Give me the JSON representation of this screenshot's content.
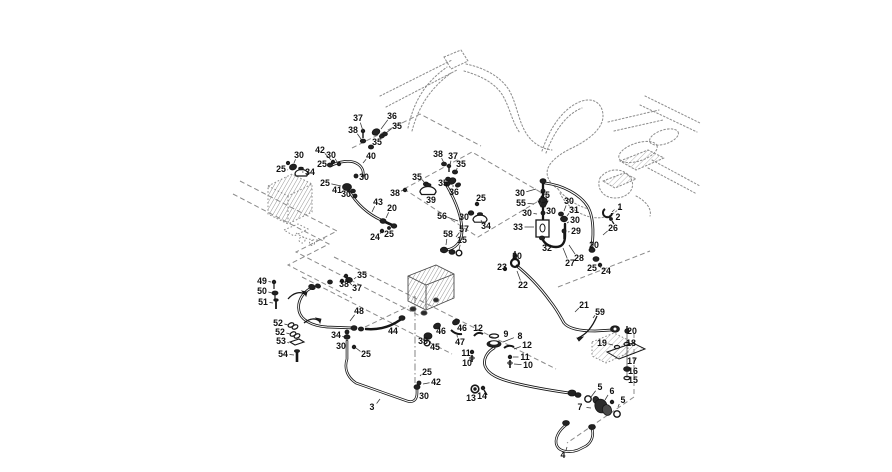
{
  "diagram": {
    "kind": "hydraulic-hose-parts-exploded-diagram",
    "background": "#ffffff",
    "part_line_color": "#161616",
    "reference_line_color": "#8f8f8f",
    "dashed_frame_color": "#8a8a8a",
    "callout_color": "#111111",
    "callout_font_size": 8.8,
    "callouts": [
      [
        "37",
        358,
        118,
        363,
        131
      ],
      [
        "38",
        353,
        130,
        361,
        139
      ],
      [
        "36",
        392,
        116,
        381,
        129
      ],
      [
        "35",
        397,
        126,
        386,
        133
      ],
      [
        "35",
        377,
        142,
        372,
        146
      ],
      [
        "40",
        371,
        156,
        363,
        163
      ],
      [
        "30",
        299,
        155,
        294,
        163
      ],
      [
        "25",
        281,
        169,
        288,
        170
      ],
      [
        "34",
        310,
        172,
        302,
        172
      ],
      [
        "42",
        320,
        150,
        331,
        160
      ],
      [
        "30",
        331,
        155,
        337,
        162
      ],
      [
        "25",
        322,
        164,
        333,
        166
      ],
      [
        "25",
        325,
        183,
        341,
        186
      ],
      [
        "30",
        364,
        177,
        357,
        177
      ],
      [
        "41",
        337,
        190,
        344,
        188
      ],
      [
        "30",
        346,
        194,
        352,
        194
      ],
      [
        "38",
        438,
        154,
        444,
        163
      ],
      [
        "37",
        453,
        156,
        450,
        165
      ],
      [
        "35",
        461,
        164,
        456,
        171
      ],
      [
        "35",
        417,
        177,
        424,
        182
      ],
      [
        "35",
        443,
        183,
        447,
        180
      ],
      [
        "36",
        454,
        192,
        453,
        185
      ],
      [
        "38",
        395,
        193,
        403,
        190
      ],
      [
        "39",
        431,
        200,
        428,
        194
      ],
      [
        "43",
        378,
        202,
        372,
        212
      ],
      [
        "20",
        392,
        208,
        386,
        218
      ],
      [
        "24",
        375,
        237,
        381,
        232
      ],
      [
        "25",
        389,
        234,
        389,
        230
      ],
      [
        "25",
        481,
        198,
        478,
        204
      ],
      [
        "30",
        464,
        217,
        470,
        214
      ],
      [
        "34",
        486,
        226,
        481,
        220
      ],
      [
        "56",
        442,
        216,
        458,
        221
      ],
      [
        "57",
        464,
        229,
        456,
        237
      ],
      [
        "58",
        448,
        234,
        446,
        245
      ],
      [
        "15",
        462,
        240,
        459,
        250
      ],
      [
        "30",
        520,
        193,
        536,
        189
      ],
      [
        "55",
        521,
        203,
        534,
        204
      ],
      [
        "30",
        527,
        213,
        537,
        214
      ],
      [
        "33",
        518,
        227,
        534,
        227
      ],
      [
        "25",
        545,
        195,
        540,
        205
      ],
      [
        "30",
        551,
        211,
        545,
        214
      ],
      [
        "30",
        569,
        201,
        564,
        211
      ],
      [
        "31",
        574,
        210,
        567,
        216
      ],
      [
        "30",
        575,
        220,
        567,
        223
      ],
      [
        "29",
        576,
        231,
        568,
        232
      ],
      [
        "32",
        547,
        248,
        551,
        243
      ],
      [
        "28",
        579,
        258,
        569,
        245
      ],
      [
        "27",
        570,
        263,
        563,
        248
      ],
      [
        "1",
        620,
        207,
        612,
        212
      ],
      [
        "2",
        618,
        217,
        613,
        219
      ],
      [
        "26",
        613,
        228,
        603,
        235
      ],
      [
        "20",
        594,
        245,
        594,
        251
      ],
      [
        "25",
        592,
        268,
        595,
        262
      ],
      [
        "24",
        606,
        271,
        600,
        266
      ],
      [
        "23",
        502,
        267,
        505,
        269
      ],
      [
        "20",
        517,
        256,
        515,
        261
      ],
      [
        "22",
        523,
        285,
        517,
        271
      ],
      [
        "21",
        584,
        305,
        575,
        312
      ],
      [
        "59",
        600,
        312,
        593,
        318
      ],
      [
        "49",
        262,
        281,
        271,
        282
      ],
      [
        "50",
        262,
        291,
        272,
        293
      ],
      [
        "51",
        263,
        302,
        273,
        303
      ],
      [
        "52",
        278,
        323,
        288,
        325
      ],
      [
        "52",
        280,
        332,
        290,
        334
      ],
      [
        "53",
        281,
        341,
        289,
        343
      ],
      [
        "54",
        283,
        354,
        294,
        355
      ],
      [
        "48",
        359,
        311,
        350,
        321
      ],
      [
        "35",
        362,
        275,
        354,
        279
      ],
      [
        "38",
        344,
        284,
        342,
        280
      ],
      [
        "37",
        357,
        288,
        349,
        282
      ],
      [
        "34",
        336,
        335,
        344,
        337
      ],
      [
        "30",
        341,
        346,
        346,
        344
      ],
      [
        "25",
        366,
        354,
        356,
        348
      ],
      [
        "3",
        372,
        407,
        380,
        399
      ],
      [
        "44",
        393,
        331,
        396,
        325
      ],
      [
        "35",
        423,
        341,
        426,
        335
      ],
      [
        "45",
        435,
        347,
        430,
        341
      ],
      [
        "46",
        441,
        331,
        437,
        328
      ],
      [
        "46",
        462,
        328,
        458,
        324
      ],
      [
        "47",
        460,
        342,
        457,
        335
      ],
      [
        "25",
        427,
        372,
        420,
        376
      ],
      [
        "42",
        436,
        382,
        423,
        384
      ],
      [
        "30",
        424,
        396,
        419,
        394
      ],
      [
        "12",
        478,
        328,
        477,
        334
      ],
      [
        "9",
        506,
        334,
        500,
        334
      ],
      [
        "8",
        520,
        336,
        503,
        342
      ],
      [
        "12",
        527,
        345,
        514,
        349
      ],
      [
        "11",
        466,
        353,
        471,
        352
      ],
      [
        "10",
        467,
        363,
        471,
        361
      ],
      [
        "11",
        525,
        357,
        513,
        357
      ],
      [
        "10",
        528,
        365,
        514,
        364
      ],
      [
        "13",
        471,
        398,
        474,
        392
      ],
      [
        "14",
        482,
        396,
        484,
        391
      ],
      [
        "20",
        632,
        331,
        630,
        332
      ],
      [
        "19",
        602,
        343,
        613,
        345
      ],
      [
        "18",
        631,
        343,
        630,
        344
      ],
      [
        "17",
        632,
        361,
        630,
        359
      ],
      [
        "16",
        633,
        371,
        630,
        370
      ],
      [
        "15",
        633,
        380,
        630,
        378
      ],
      [
        "5",
        600,
        387,
        591,
        397
      ],
      [
        "6",
        612,
        391,
        605,
        400
      ],
      [
        "5",
        623,
        400,
        618,
        407
      ],
      [
        "7",
        580,
        407,
        591,
        408
      ],
      [
        "4",
        563,
        455,
        567,
        447
      ]
    ]
  }
}
